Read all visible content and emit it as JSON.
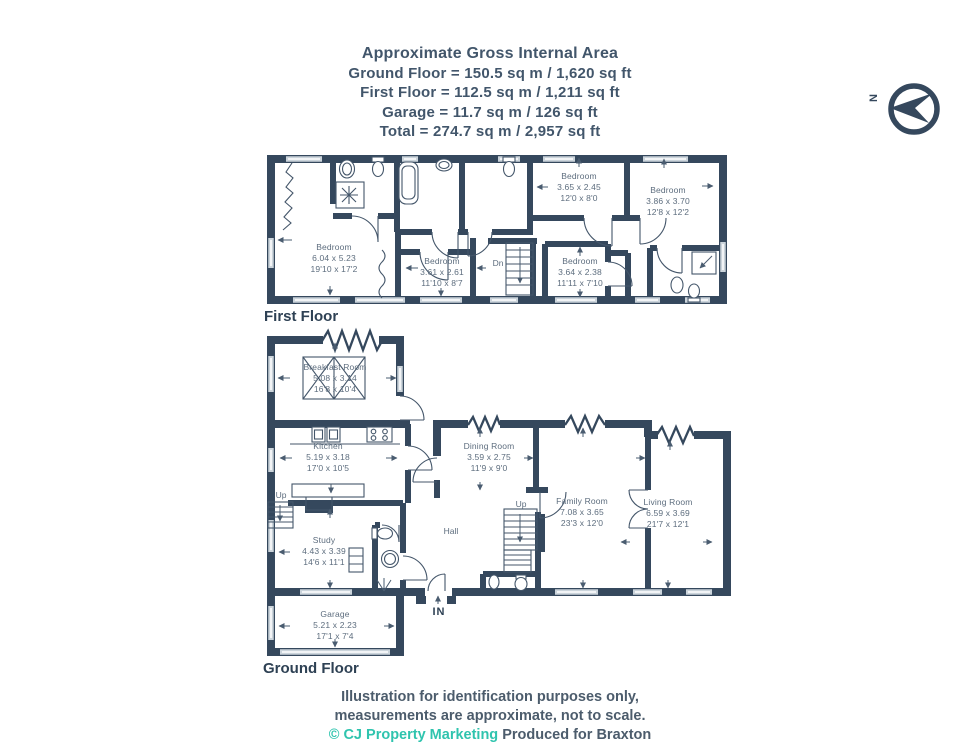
{
  "header": {
    "title": "Approximate Gross Internal Area",
    "lines": [
      "Ground Floor = 150.5 sq m / 1,620 sq ft",
      "First Floor = 112.5 sq m / 1,211 sq ft",
      "Garage = 11.7 sq m / 126 sq ft",
      "Total = 274.7 sq m / 2,957 sq ft"
    ]
  },
  "compass": {
    "north_label": "N"
  },
  "floors": {
    "first": {
      "label": "First Floor",
      "stairs_label": "Dn",
      "rooms": [
        {
          "name": "Bedroom",
          "metric": "6.04 x 5.23",
          "imperial": "19'10 x 17'2"
        },
        {
          "name": "Bedroom",
          "metric": "3.61 x 2.61",
          "imperial": "11'10 x 8'7"
        },
        {
          "name": "Bedroom",
          "metric": "3.65 x 2.45",
          "imperial": "12'0 x 8'0"
        },
        {
          "name": "Bedroom",
          "metric": "3.86 x 3.70",
          "imperial": "12'8 x 12'2"
        },
        {
          "name": "Bedroom",
          "metric": "3.64 x 2.38",
          "imperial": "11'11 x 7'10"
        }
      ]
    },
    "ground": {
      "label": "Ground Floor",
      "stairs_main_label": "Up",
      "stairs_side_label": "Up",
      "hall_label": "Hall",
      "entrance_label": "IN",
      "rooms": [
        {
          "name": "Breakfast Room",
          "metric": "5.08 x 3.14",
          "imperial": "16'8 x 10'4"
        },
        {
          "name": "Kitchen",
          "metric": "5.19 x 3.18",
          "imperial": "17'0 x 10'5"
        },
        {
          "name": "Dining Room",
          "metric": "3.59 x 2.75",
          "imperial": "11'9 x 9'0"
        },
        {
          "name": "Family Room",
          "metric": "7.08 x 3.65",
          "imperial": "23'3 x 12'0"
        },
        {
          "name": "Living Room",
          "metric": "6.59 x 3.69",
          "imperial": "21'7 x 12'1"
        },
        {
          "name": "Study",
          "metric": "4.43 x 3.39",
          "imperial": "14'6 x 11'1"
        },
        {
          "name": "Garage",
          "metric": "5.21 x 2.23",
          "imperial": "17'1 x 7'4"
        }
      ]
    }
  },
  "footer": {
    "line1": "Illustration for identification purposes only,",
    "line2": "measurements are approximate, not to scale.",
    "credit": "© CJ Property Marketing",
    "produced": "Produced for Braxton"
  },
  "colors": {
    "wall": "#35485d",
    "accent": "#2fc4ae",
    "label_text": "#5d6d7e"
  }
}
